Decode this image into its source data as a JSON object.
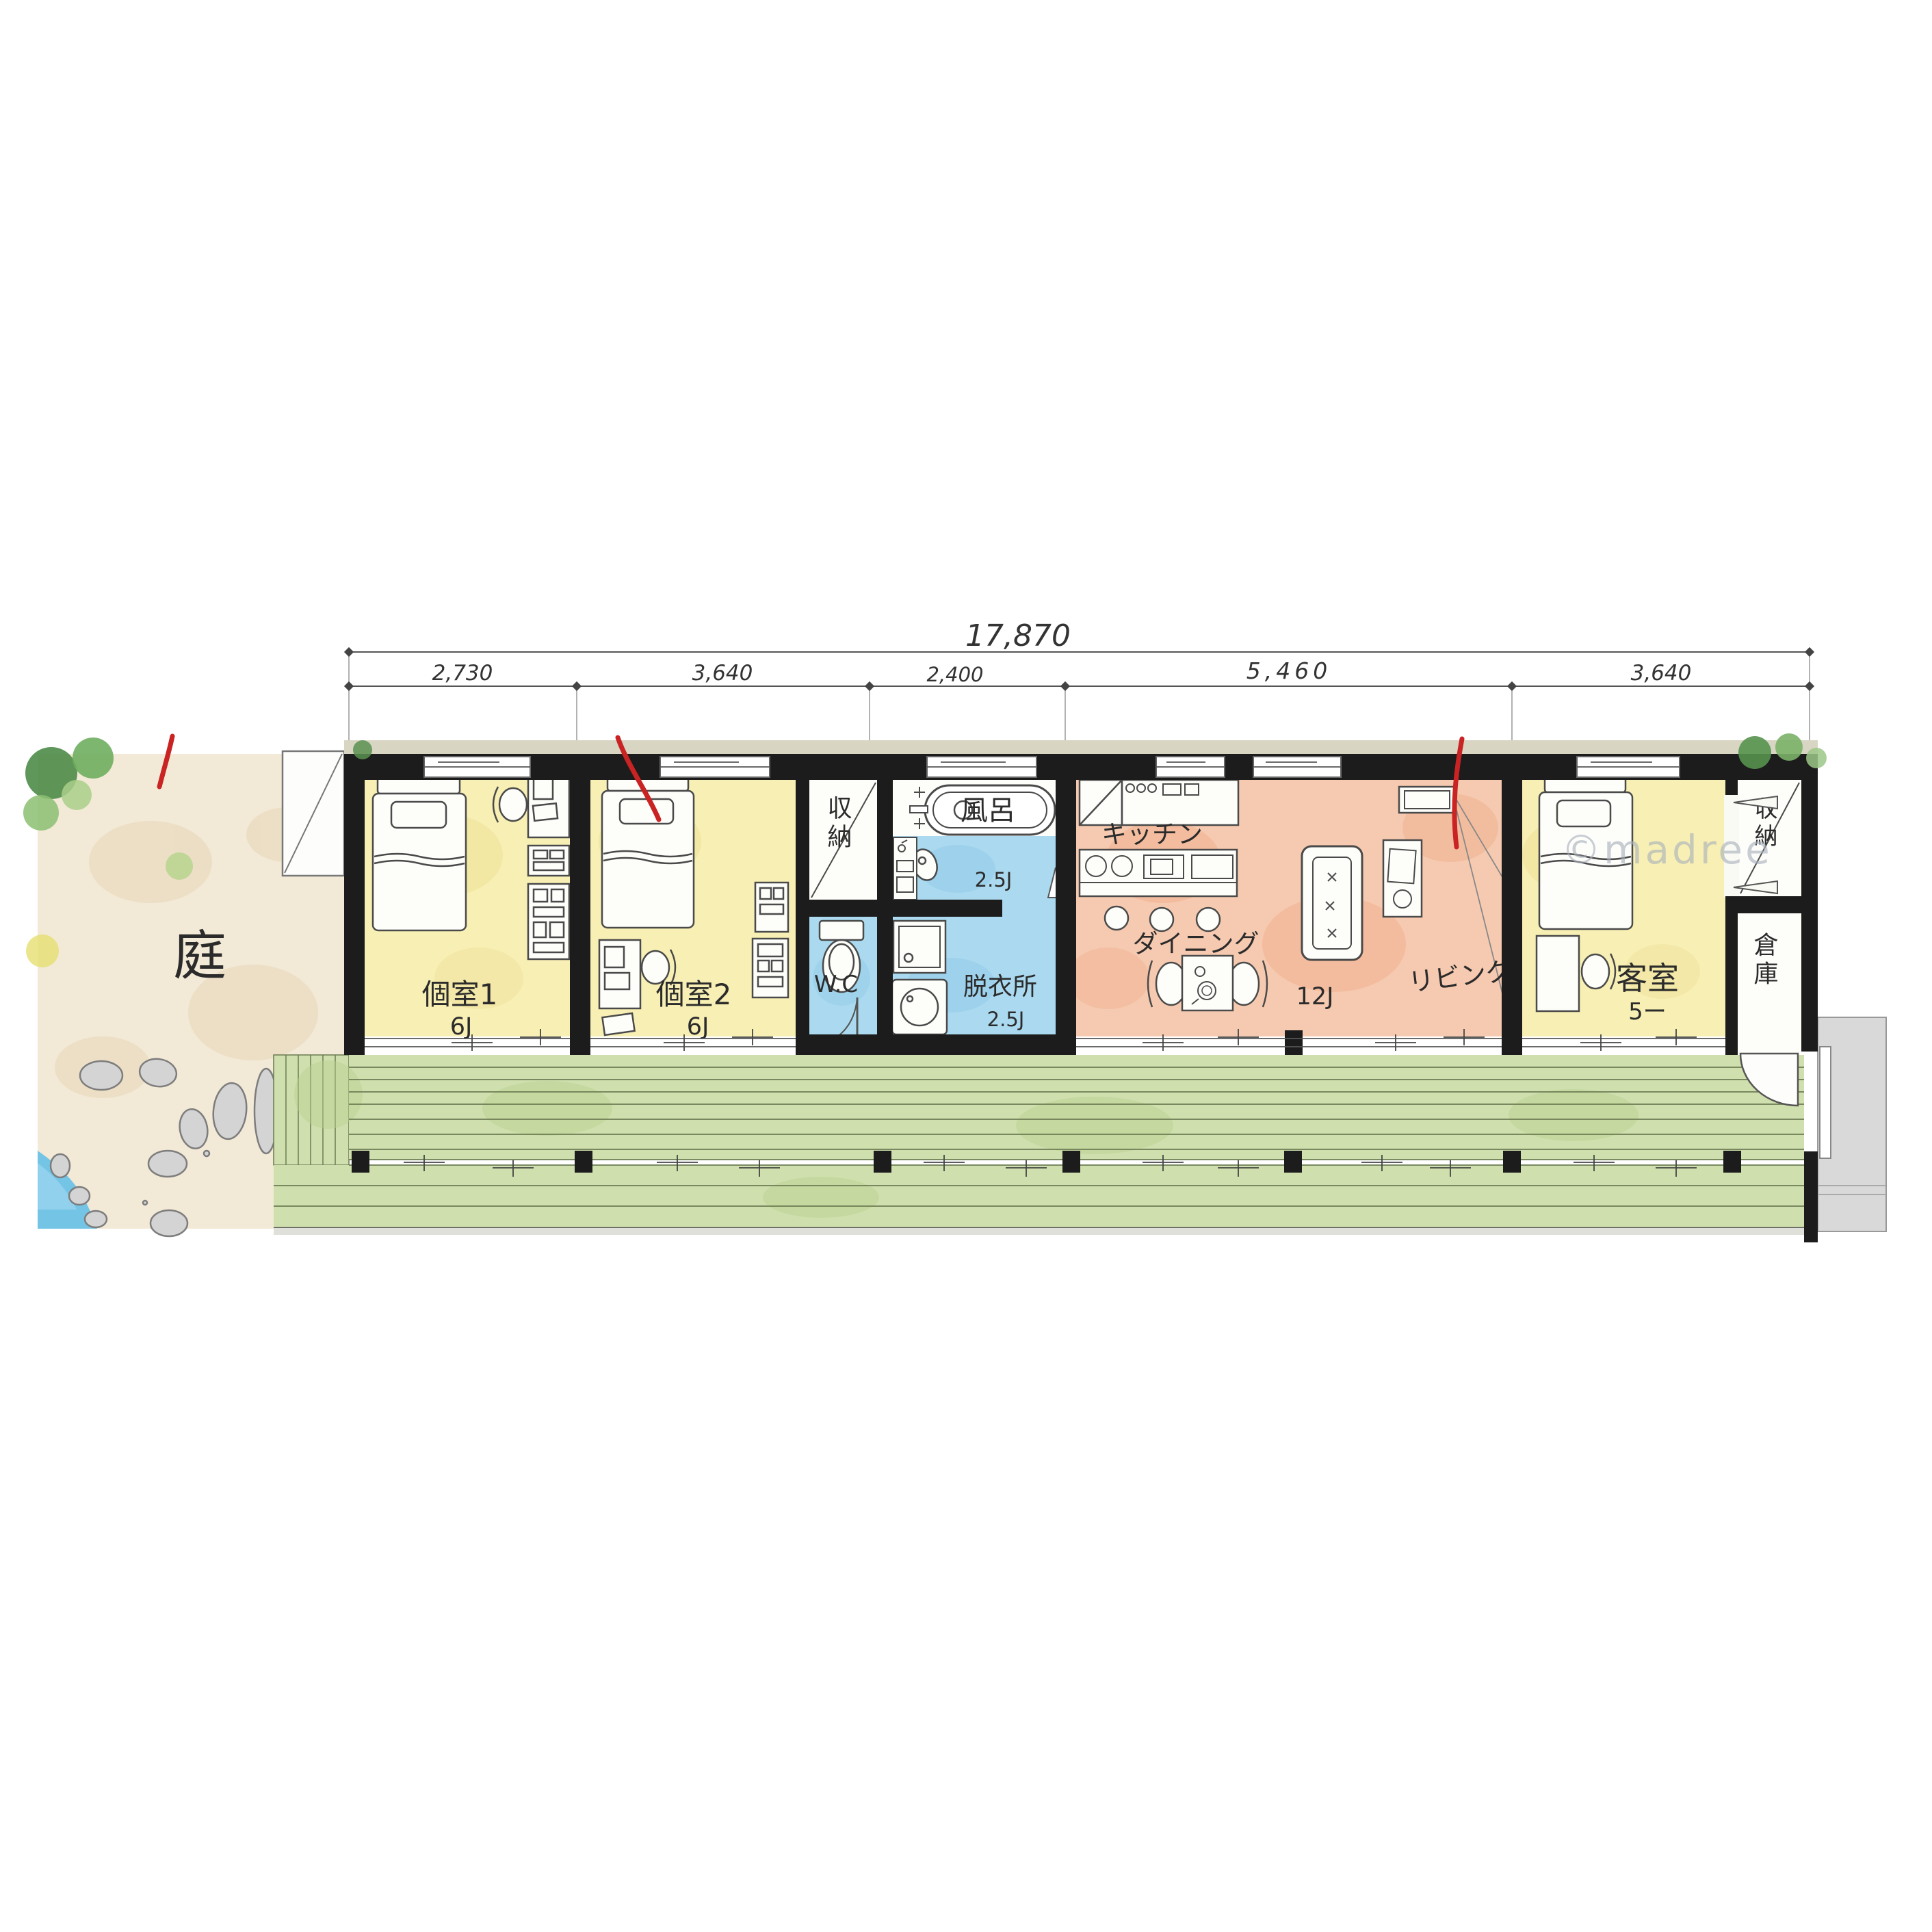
{
  "plan_type": "hand-drawn watercolor floor plan",
  "dimensions": {
    "total_width_mm": "17,870",
    "top_segments_mm": [
      "2,730",
      "3,640",
      "2,400",
      "5,460",
      "3,640"
    ],
    "left_segments_mm": [
      "3,640",
      "1,200"
    ]
  },
  "rooms": {
    "garden": {
      "label": "庭"
    },
    "bedroom1": {
      "label": "個室1",
      "size": "6J"
    },
    "bedroom2": {
      "label": "個室2",
      "size": "6J"
    },
    "closet_center": {
      "label": "収納"
    },
    "toilet": {
      "label": "W.C"
    },
    "bath": {
      "label": "風呂",
      "size": "2.5J"
    },
    "dressing_room": {
      "label": "脱衣所",
      "size": "2.5J"
    },
    "kitchen": {
      "label": "キッチン"
    },
    "dining": {
      "label": "ダイニング"
    },
    "living": {
      "label": "リビング",
      "size": "12J"
    },
    "guest_room": {
      "label": "客室",
      "size": "5ー"
    },
    "closet_east": {
      "label": "収納"
    },
    "storage": {
      "label": "倉庫"
    }
  },
  "watermark": "©madree",
  "colors": {
    "wall": "#1c1c1c",
    "bedroom_yellow": "#f7efb4",
    "ldk_orange": "#f6cab0",
    "wet_blue": "#abdaf0",
    "deck_green": "#cfe0ae",
    "garden_beige": "#f2e9d6",
    "water_blue": "#74c4e6",
    "stone_gray": "#d4d4d4",
    "path_gray": "#d9d9d9",
    "annotation_red": "#c92323"
  }
}
